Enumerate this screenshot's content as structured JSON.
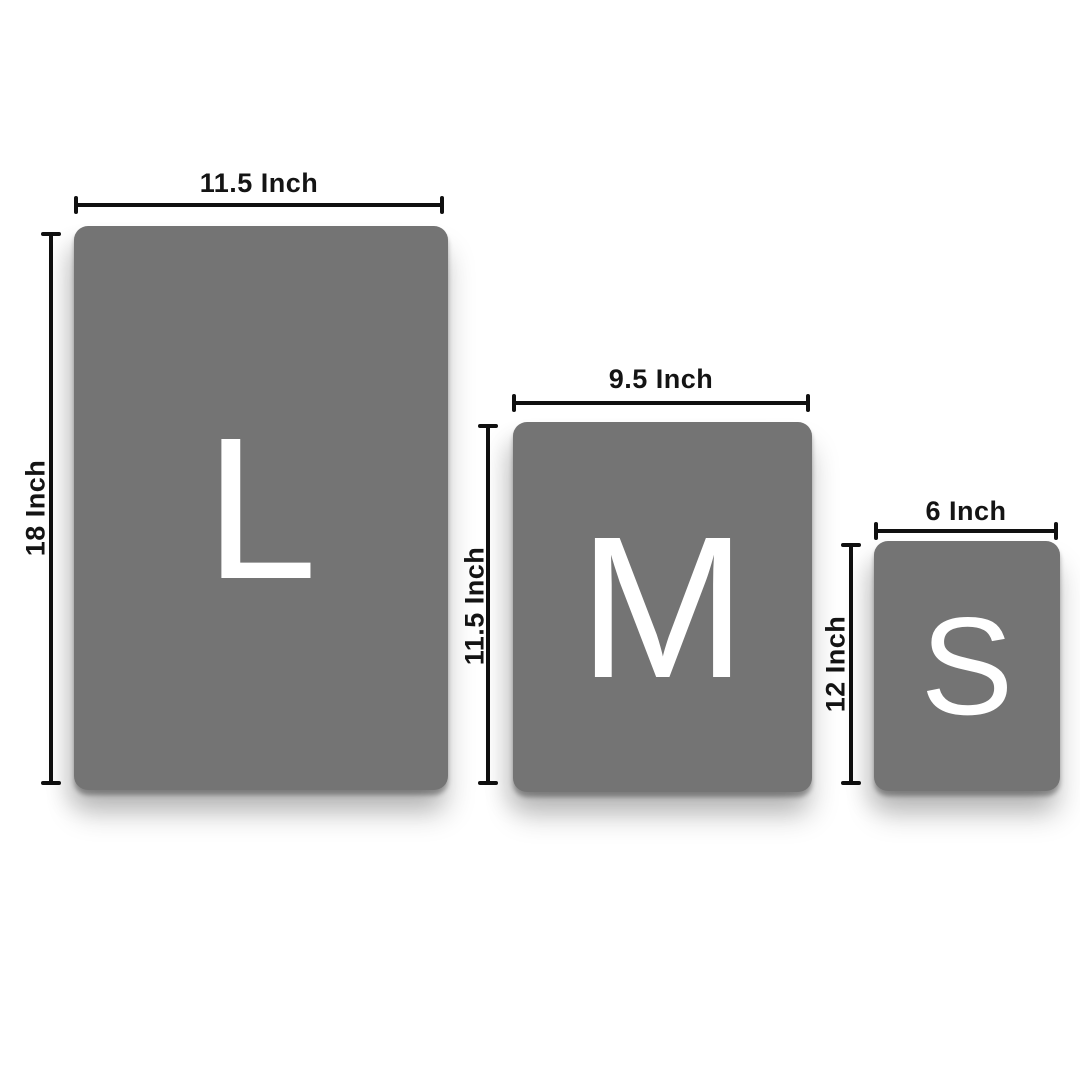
{
  "colors": {
    "background": "#ffffff",
    "panel_gray": "#747474",
    "dimension_line": "#101010",
    "label_text": "#141414",
    "letter_text": "#ffffff"
  },
  "sizes": [
    {
      "id": "large",
      "letter": "L",
      "width_label": "11.5 Inch",
      "height_label": "18 Inch",
      "width_inches": 11.5,
      "height_inches": 18
    },
    {
      "id": "medium",
      "letter": "M",
      "width_label": "9.5 Inch",
      "height_label": "11.5 Inch",
      "width_inches": 9.5,
      "height_inches": 11.5
    },
    {
      "id": "small",
      "letter": "S",
      "width_label": "6 Inch",
      "height_label": "12 Inch",
      "width_inches": 6,
      "height_inches": 12
    }
  ]
}
